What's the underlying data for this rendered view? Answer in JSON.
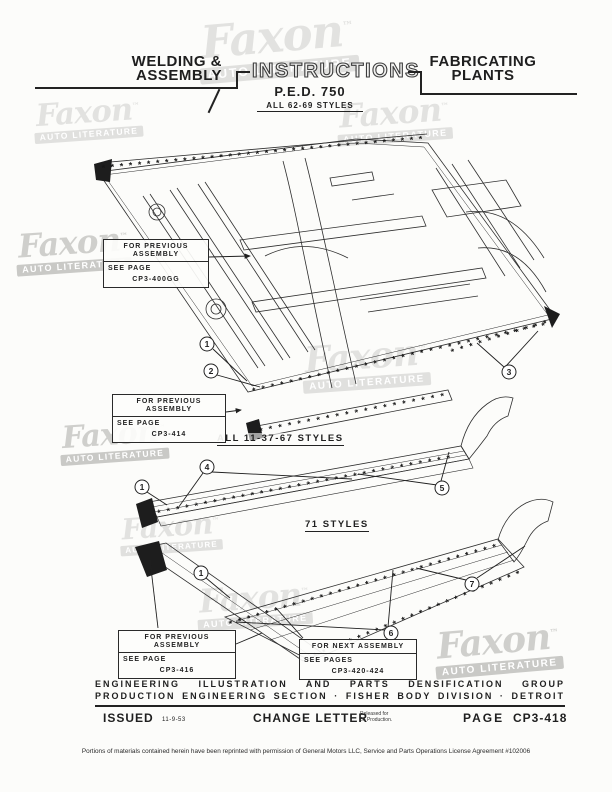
{
  "colors": {
    "ink": "#1f1f1f",
    "paper": "#fcfcfa",
    "watermark_light": "#e2e2e0",
    "watermark_dark": "#cfcfcc"
  },
  "header": {
    "left_line1": "WELDING &",
    "left_line2": "ASSEMBLY",
    "title": "INSTRUCTIONS",
    "ped": "P.E.D. 750",
    "all_styles": "ALL 62-69 STYLES",
    "right_line1": "FABRICATING",
    "right_line2": "PLANTS"
  },
  "section_labels": {
    "mid": "ALL 11-37-67 STYLES",
    "bottom": "71 STYLES"
  },
  "callouts": {
    "prev_main": {
      "line1": "FOR PREVIOUS",
      "line2": "ASSEMBLY",
      "see": "SEE PAGE",
      "page": "CP3-400GG"
    },
    "prev_mid": {
      "line1": "FOR PREVIOUS",
      "line2": "ASSEMBLY",
      "see": "SEE PAGE",
      "page": "CP3-414"
    },
    "prev_bottom": {
      "line1": "FOR PREVIOUS",
      "line2": "ASSEMBLY",
      "see": "SEE PAGE",
      "page": "CP3-416"
    },
    "next": {
      "line1": "FOR NEXT ASSEMBLY",
      "see": "SEE PAGES",
      "page": "CP3-420-424"
    }
  },
  "markers": {
    "main": [
      "1",
      "2",
      "3"
    ],
    "mid": [
      "1",
      "4",
      "5"
    ],
    "bottom": [
      "1",
      "6",
      "7"
    ]
  },
  "footer": {
    "group_line1": "ENGINEERING ILLUSTRATION AND PARTS DENSIFICATION GROUP",
    "group_line2": "PRODUCTION ENGINEERING SECTION · FISHER BODY DIVISION · DETROIT",
    "issued_label": "ISSUED",
    "issued_date": "11-9-53",
    "change_label": "CHANGE LETTER",
    "change_note_line1": "Released for",
    "change_note_line2": "56 Production.",
    "page_label": "PAGE",
    "page_number": "CP3-418"
  },
  "license": "Portions of materials contained herein have been reprinted with permission of General Motors LLC, Service and Parts Operations License Agreement #102006",
  "watermark": {
    "script": "Faxon",
    "tm": "™",
    "bar": "AUTO LITERATURE"
  },
  "illustration": {
    "rows": {
      "r36": "* * * * * * * * * * * * * * * * * * * * * * * * * * * * * * * * * * * *",
      "r32": "* * * * * * * * * * * * * * * * * * * * * * * * * * * * * * * *",
      "r30": "* * * * * * * * * * * * * * * * * * * * * * * * * * * * * *",
      "r24": "* * * * * * * * * * * * * * * * * * * * * * * *",
      "r20": "* * * * * * * * * * * * * * * * * * * *",
      "r11": "* * * * * * * * * * *"
    }
  }
}
